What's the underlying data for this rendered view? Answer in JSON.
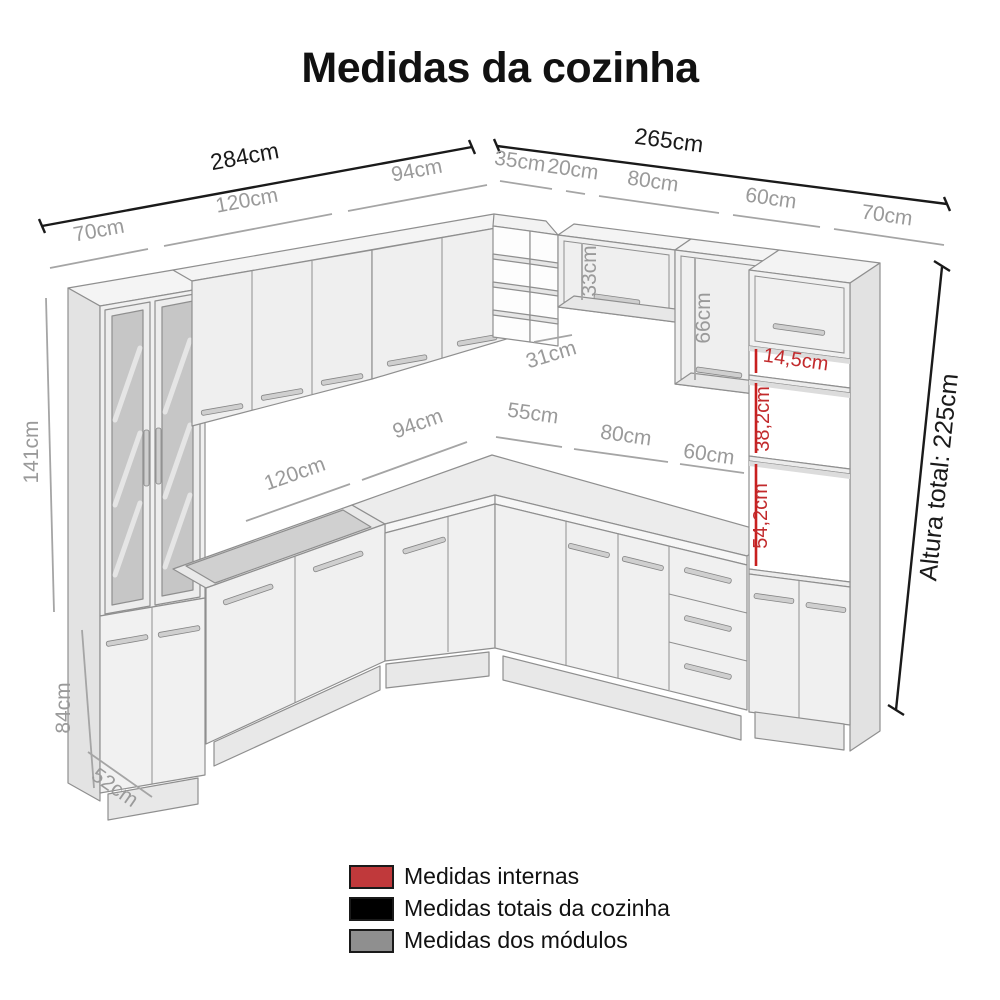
{
  "title": "Medidas da cozinha",
  "colors": {
    "total_lines": "#1a1a1a",
    "module_lines": "#9a9a9a",
    "internal_lines": "#c22a2c"
  },
  "dims": {
    "left_total": "284cm",
    "left_modules": [
      "70cm",
      "120cm",
      "94cm"
    ],
    "right_total": "265cm",
    "right_modules": [
      "35cm",
      "20cm",
      "80cm",
      "60cm",
      "70cm"
    ],
    "counter_left": [
      "120cm",
      "94cm"
    ],
    "counter_right": [
      "55cm",
      "80cm",
      "60cm"
    ],
    "tall_upper_height": "141cm",
    "tall_base_height": "84cm",
    "base_depth": "52cm",
    "overwindow_height": "33cm",
    "wallcab_height": "66cm",
    "corner_depth": "31cm",
    "internal": [
      "14,5cm",
      "38,2cm",
      "54,2cm"
    ],
    "total_height": "Altura total: 225cm"
  },
  "legend": {
    "items": [
      {
        "label": "Medidas internas",
        "color": "#c0393b"
      },
      {
        "label": "Medidas totais da cozinha",
        "color": "#000000"
      },
      {
        "label": "Medidas dos módulos",
        "color": "#8f8f8f"
      }
    ]
  }
}
